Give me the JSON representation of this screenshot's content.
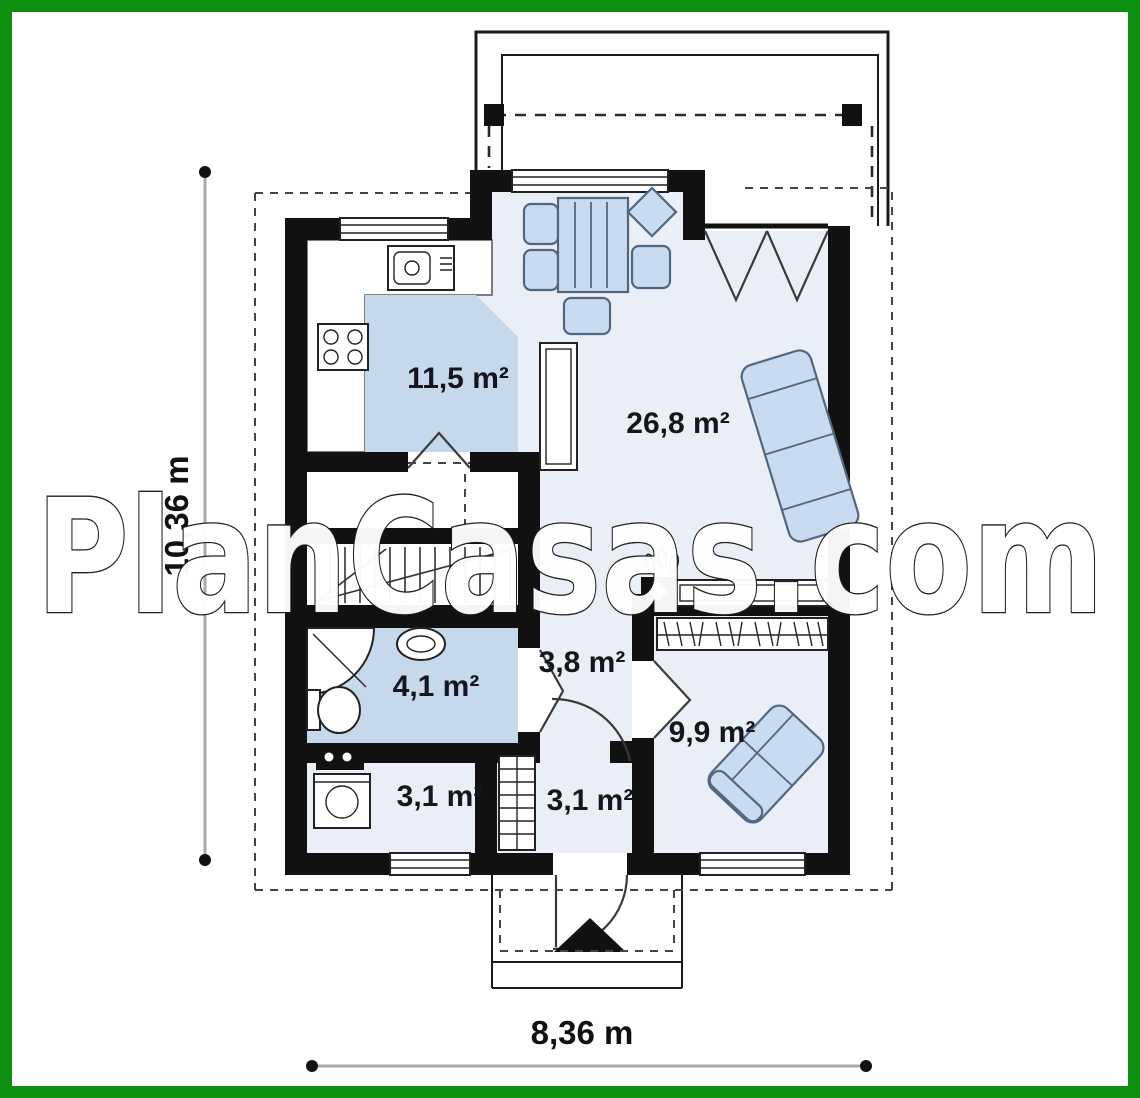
{
  "watermark": {
    "text": "PlanCasas.com"
  },
  "dimensions": {
    "height_label": "10,36 m",
    "width_label": "8,36 m"
  },
  "rooms": [
    {
      "id": "kitchen",
      "area_label": "11,5 m²"
    },
    {
      "id": "living-dining",
      "area_label": "26,8 m²"
    },
    {
      "id": "hallway",
      "area_label": "3,8 m²"
    },
    {
      "id": "bathroom",
      "area_label": "4,1 m²"
    },
    {
      "id": "bedroom",
      "area_label": "9,9 m²"
    },
    {
      "id": "utility-room",
      "area_label": "3,1 m²"
    },
    {
      "id": "entry-hall",
      "area_label": "3,1 m²"
    }
  ],
  "symbols": [
    "dining-table-icon",
    "chair-icon",
    "sofa-icon",
    "fireplace-icon",
    "media-shelf-icon",
    "wardrobe-hangers-icon",
    "bed-couch-icon",
    "corner-shower-icon",
    "washbasin-icon",
    "toilet-icon",
    "washing-machine-icon",
    "cooktop-icon",
    "kitchen-sink-icon",
    "stairs-icon",
    "radiator-icon",
    "entrance-arrow-icon",
    "terrace-post-icon"
  ],
  "colors": {
    "frame_green": "#0d9010",
    "wall_black": "#111111",
    "room_light": "#e9eef7",
    "room_medium": "#c6d8ec",
    "furniture_fill": "#c9dbf0",
    "furniture_stroke": "#52677f",
    "dim_line": "#a9a9a9",
    "label_color": "#15151f"
  }
}
